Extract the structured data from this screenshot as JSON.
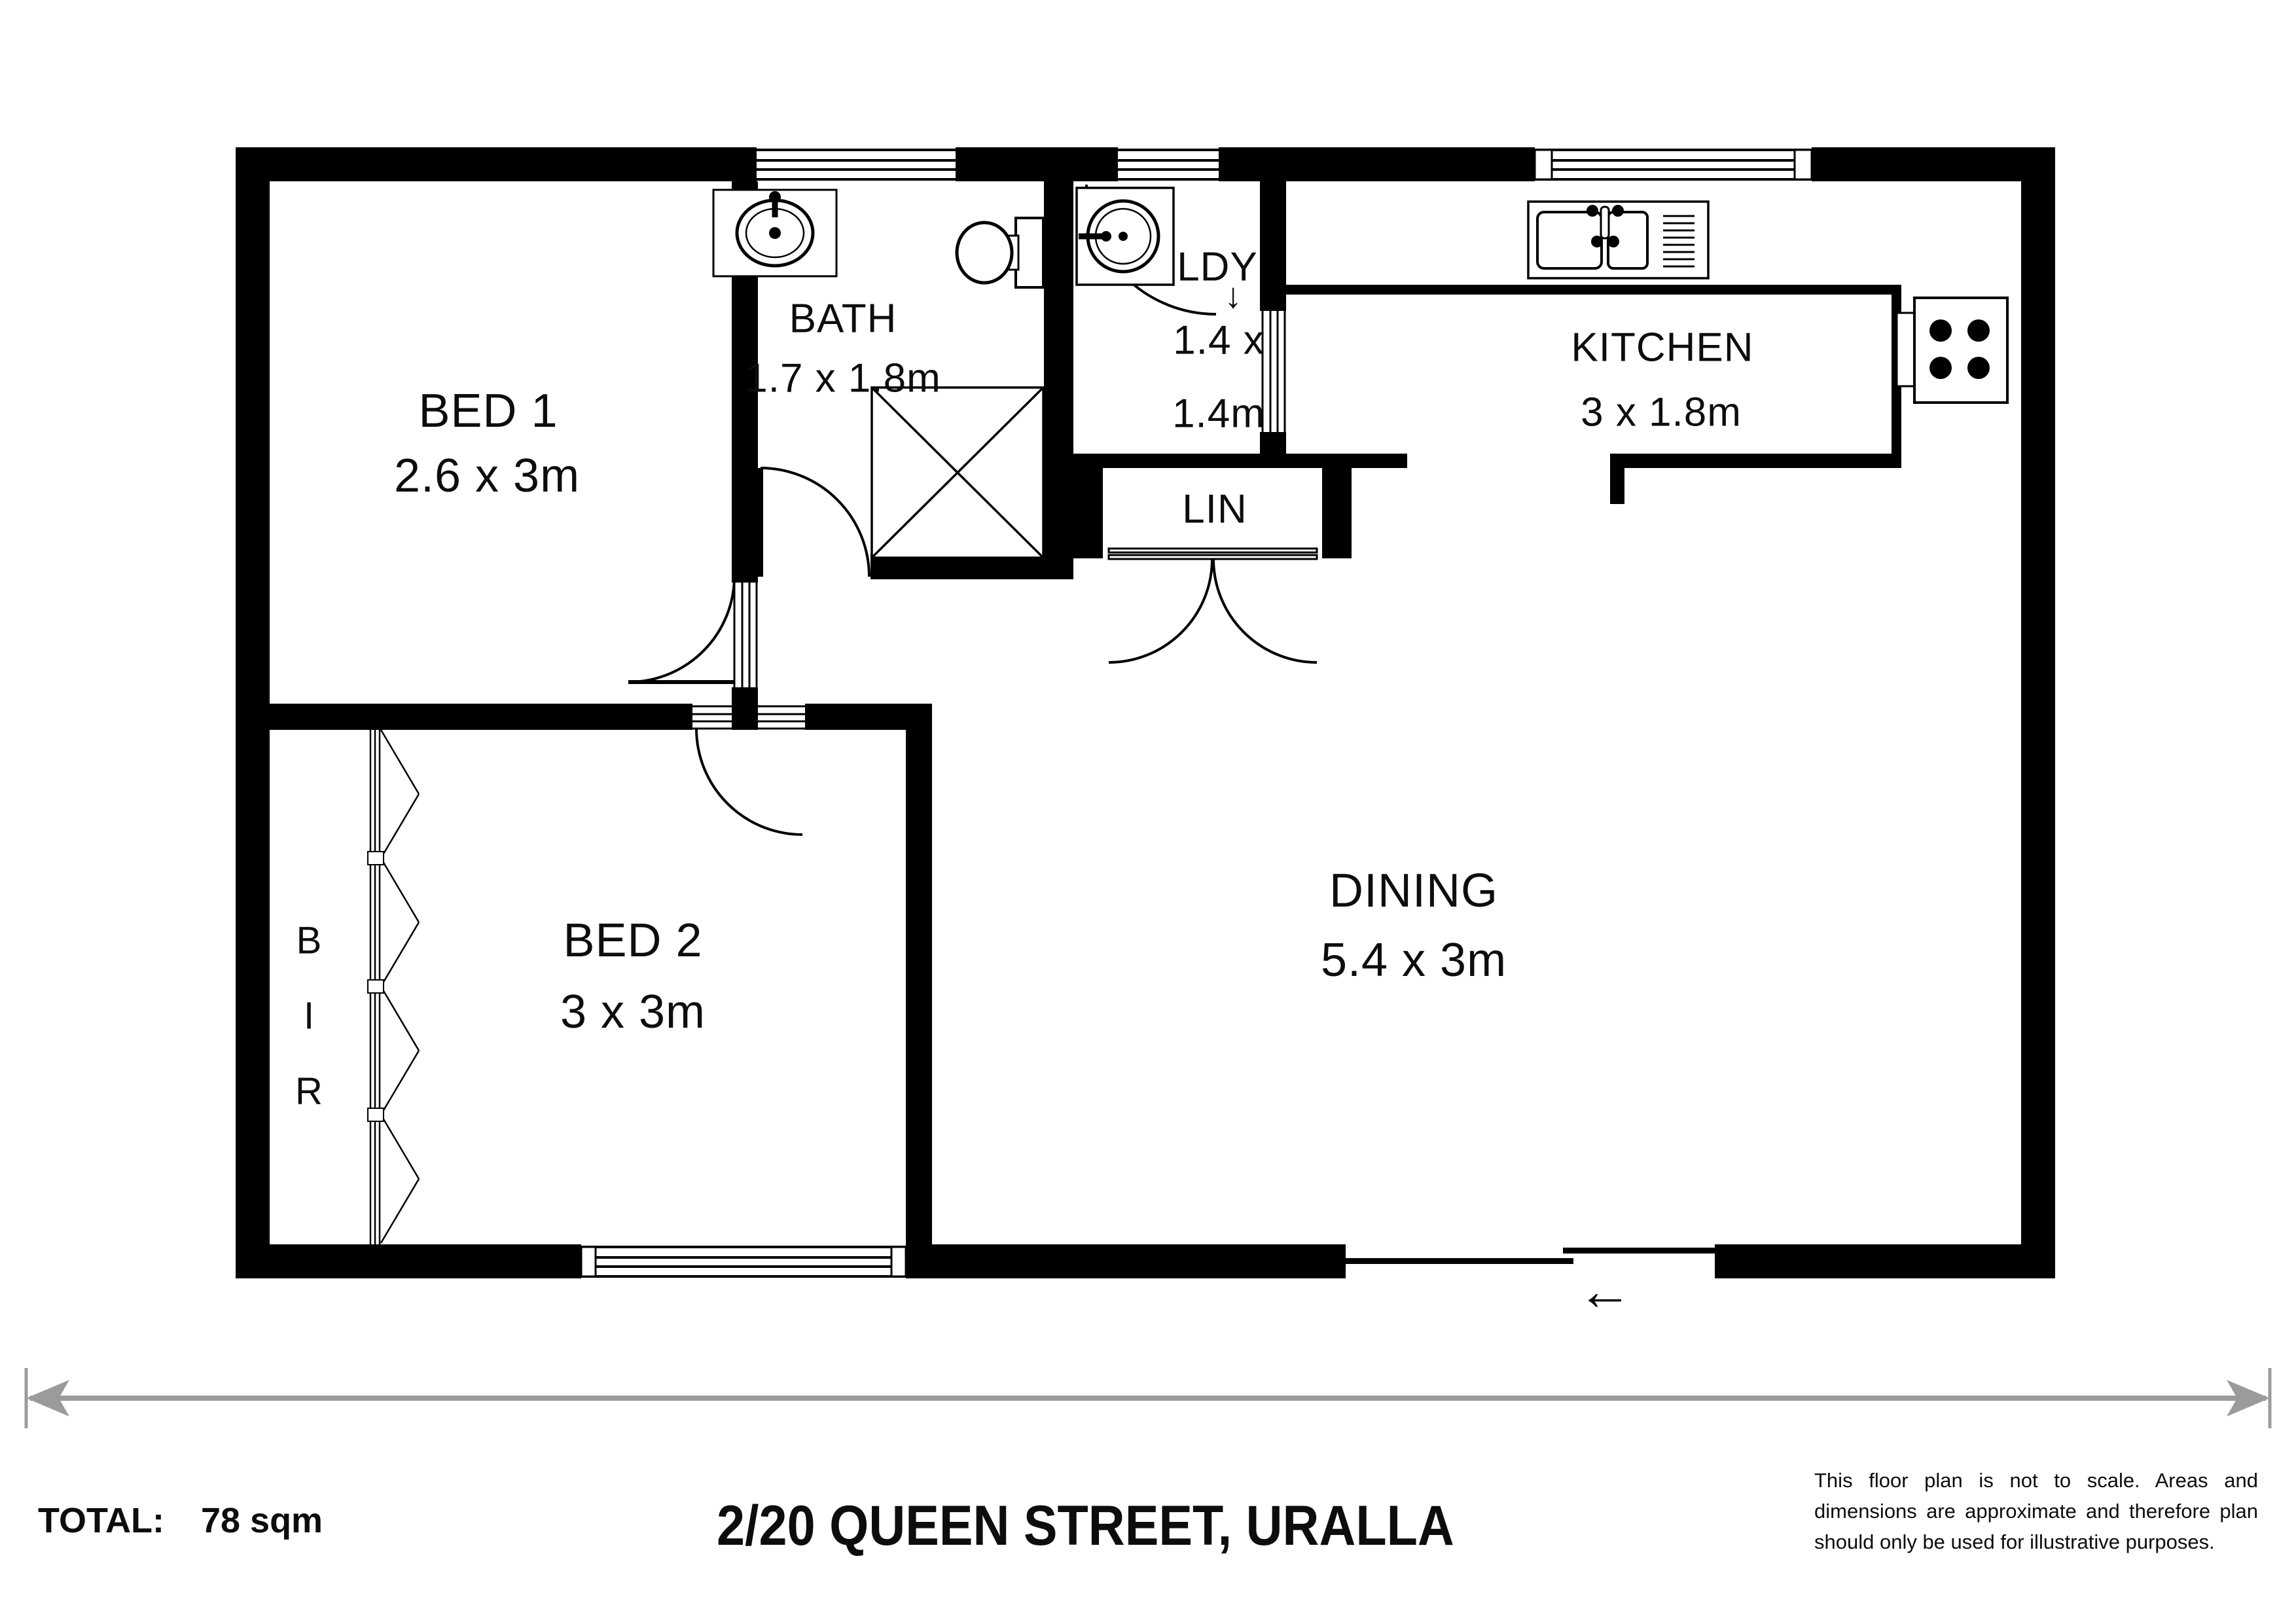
{
  "floor_plan": {
    "rooms": {
      "bed1": {
        "name": "BED 1",
        "dims": "2.6 x 3m"
      },
      "bed2": {
        "name": "BED 2",
        "dims": "3 x 3m"
      },
      "bath": {
        "name": "BATH",
        "dims": "1.7 x 1.8m"
      },
      "laundry": {
        "name": "LDY",
        "dims_line1": "1.4 x",
        "dims_line2": "1.4m"
      },
      "kitchen": {
        "name": "KITCHEN",
        "dims": "3 x 1.8m"
      },
      "dining": {
        "name": "DINING",
        "dims": "5.4 x 3m"
      },
      "linen": {
        "name": "LIN"
      },
      "robe": {
        "letter1": "B",
        "letter2": "I",
        "letter3": "R"
      }
    },
    "symbols": {
      "entry_arrow": "←",
      "step_arrow": "↓"
    },
    "fixtures": [
      "bathroom-basin",
      "toilet",
      "shower",
      "laundry-tub",
      "kitchen-sink",
      "cooktop"
    ]
  },
  "footer": {
    "total_label": "TOTAL:",
    "total_value": "78 sqm",
    "title": "2/20 QUEEN STREET, URALLA",
    "disclaimer": "This floor plan is not to scale. Areas and dimensions are approximate and therefore plan should only be used for illustrative purposes."
  },
  "colors": {
    "wall": "#000000",
    "background": "#ffffff",
    "scale_line": "#9b9b9b",
    "text": "#0d0d0d"
  }
}
